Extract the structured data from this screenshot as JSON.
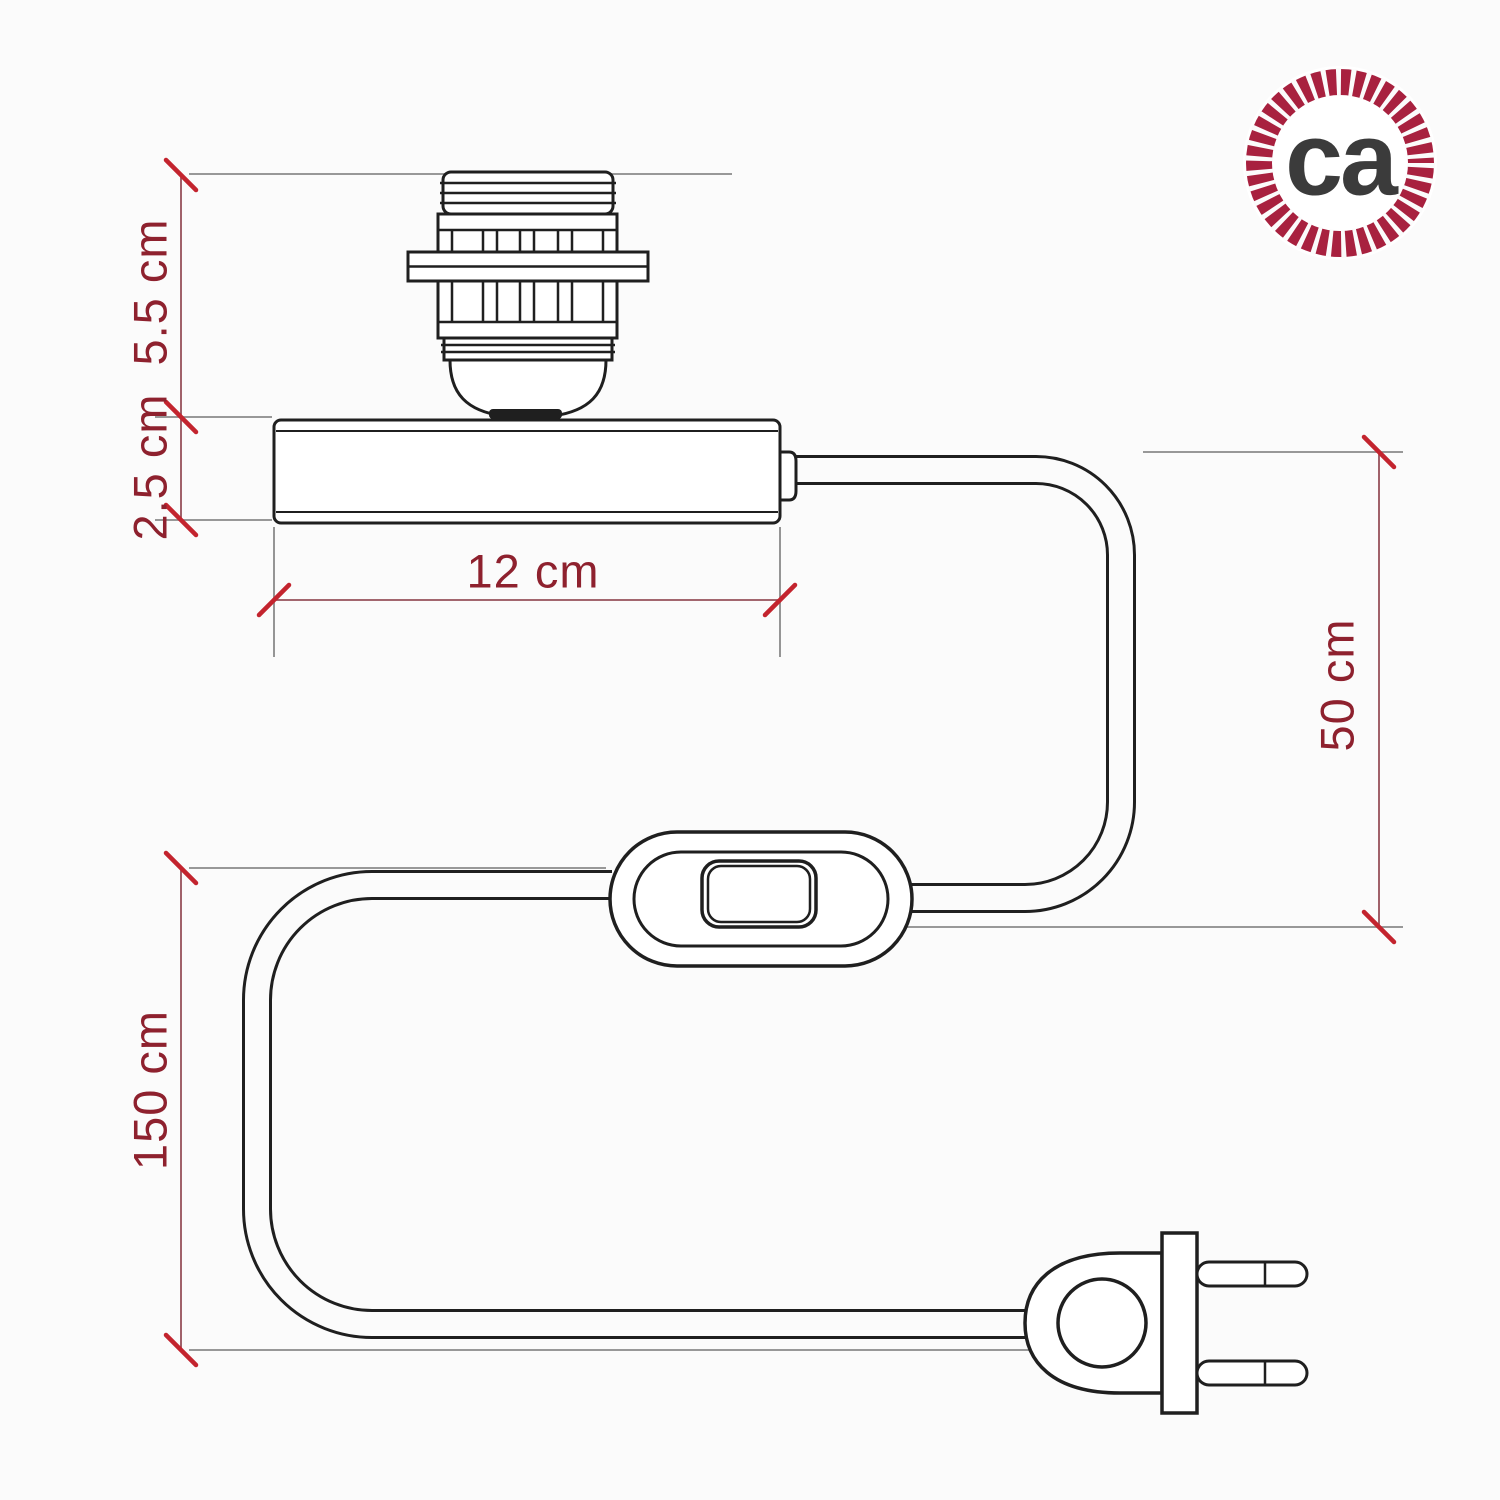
{
  "page": {
    "background_color": "#fbfbfb",
    "subject": "Technical dimension drawing of a cylindrical table-lamp base with E27 lamp holder for lampshade, fabric cable, inline rocker switch and two-pin plug"
  },
  "drawing": {
    "ink_color": "#1f1f1f",
    "dimension_line_color": "#96505a",
    "extension_line_color": "#8a8a8a",
    "tick_color": "#c3242e",
    "label_color": "#8e212e",
    "dimensions": {
      "socket_height": {
        "label": "5.5 cm",
        "measures": "lamp holder height above base"
      },
      "base_height": {
        "label": "2.5 cm",
        "measures": "cylinder base height"
      },
      "base_width": {
        "label": "12 cm",
        "measures": "cylinder base length"
      },
      "upper_cable_run": {
        "label": "50 cm",
        "measures": "cable from base to switch"
      },
      "lower_cable_run": {
        "label": "150 cm",
        "measures": "cable from switch to plug"
      }
    },
    "parts": {
      "lamp_holder": "E27 threaded lamp holder with shade ring",
      "base": "cylindrical base",
      "switch": "inline rocker switch",
      "plug": "two-pin plug"
    }
  },
  "logo": {
    "monogram": "ca",
    "ring_color": "#a8213f",
    "text_color": "#3b3b3b"
  }
}
